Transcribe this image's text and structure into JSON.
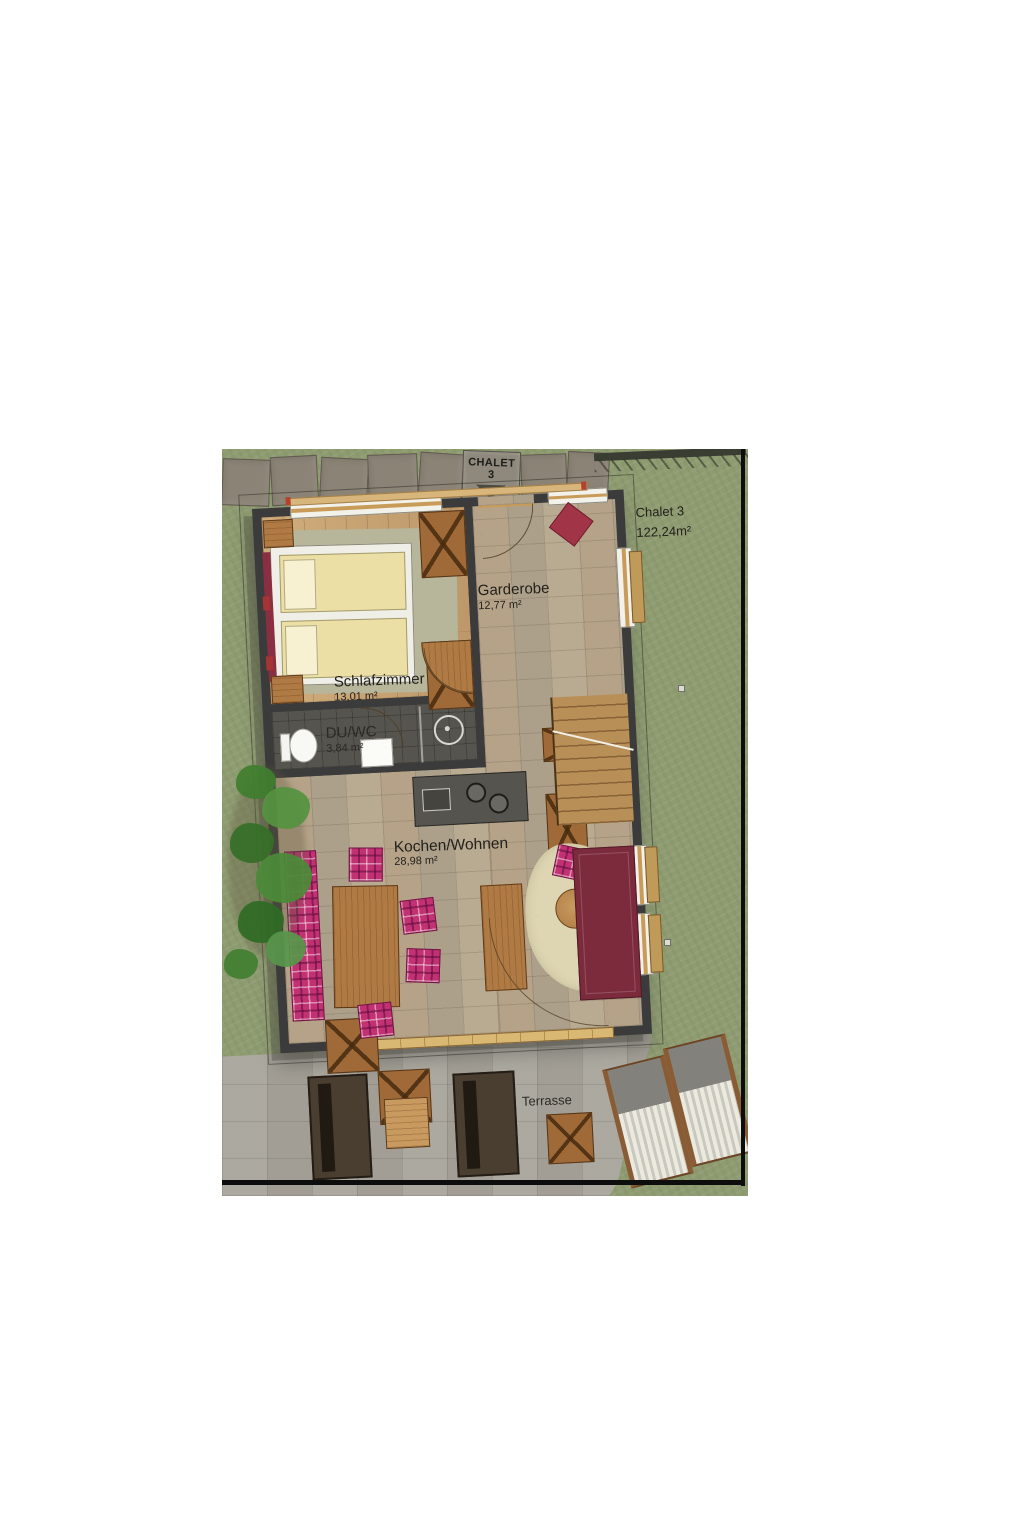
{
  "site": {
    "sign": "CHALET 3",
    "parcel": {
      "title": "Chalet 3",
      "area": "122,24m²"
    }
  },
  "rooms": {
    "garderobe": {
      "name": "Garderobe",
      "area": "12,77 m²"
    },
    "schlafzimmer": {
      "name": "Schlafzimmer",
      "area": "13,01 m²"
    },
    "du_wc": {
      "name": "DU/WC",
      "area": "3,84 m²"
    },
    "kochen_wohnen": {
      "name": "Kochen/Wohnen",
      "area": "28,98 m²"
    },
    "terrasse": {
      "name": "Terrasse"
    }
  },
  "colors": {
    "grass": "#8f9c72",
    "pavement": "#a8a49b",
    "wall": "#3b3b3b",
    "wood": "#b07a44",
    "wood_floor": "#c7a273",
    "tile": "#b3a58e",
    "plaid": "#c23272",
    "burgundy": "#7c2b3c",
    "cream_rug": "#ded6b2",
    "mattress": "#ebdfa6",
    "boundary": "#0d0d0d"
  }
}
